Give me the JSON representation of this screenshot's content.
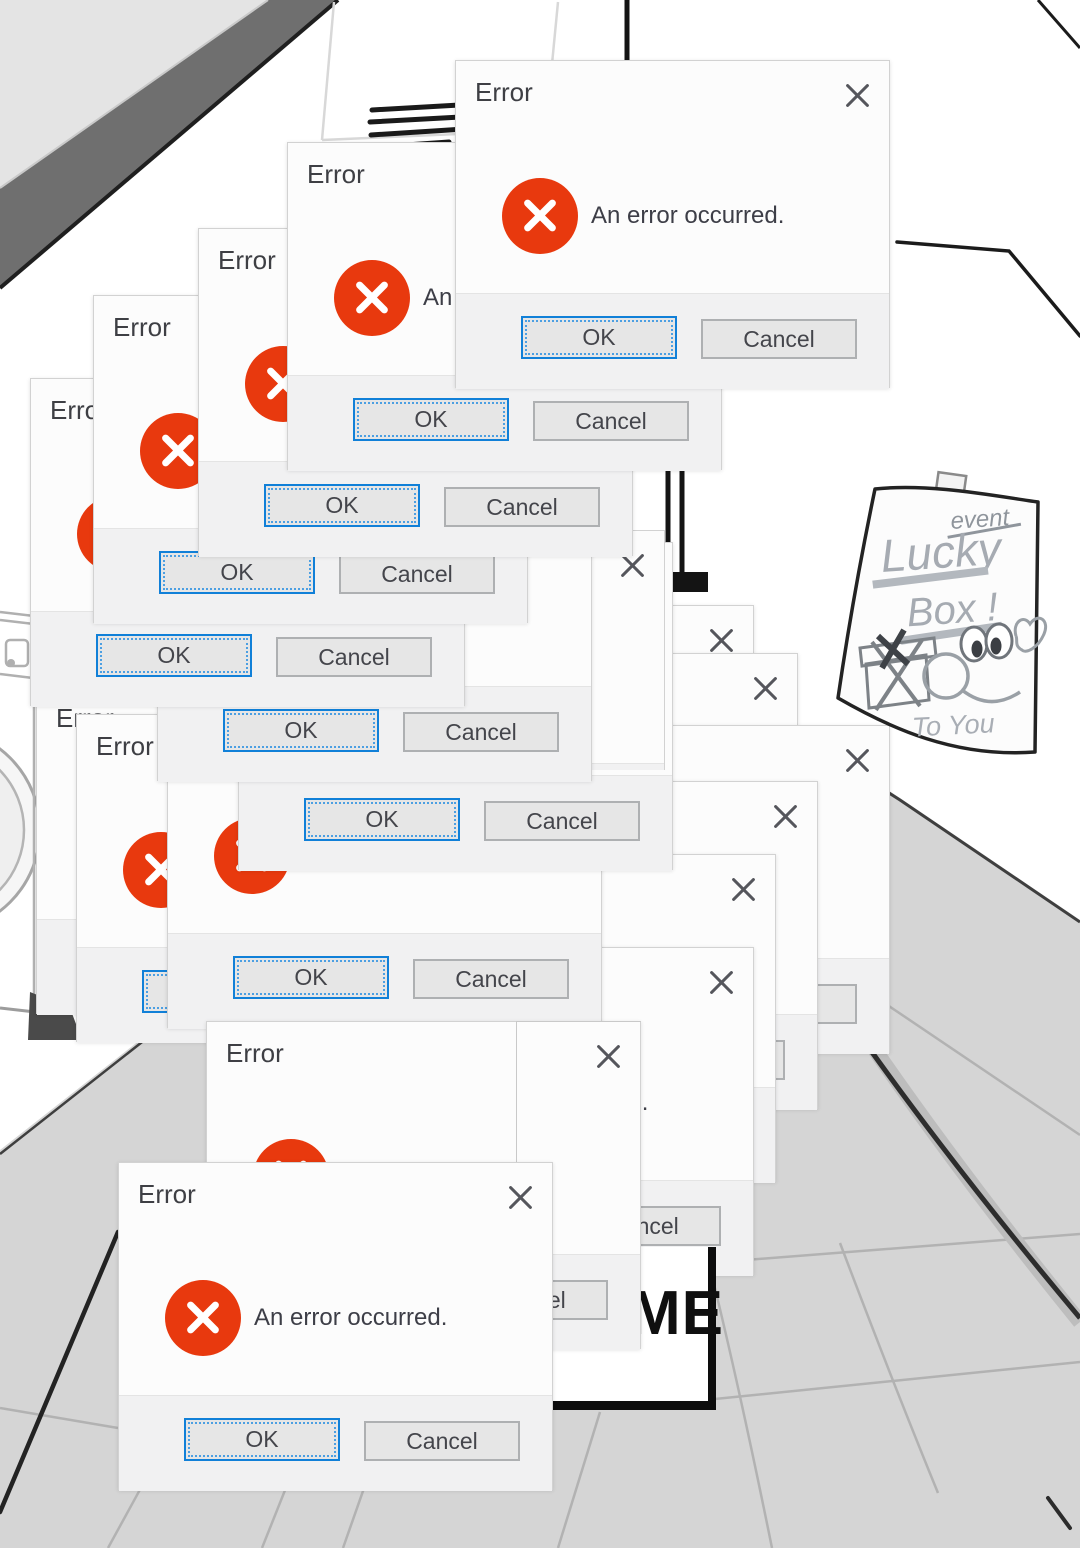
{
  "scene": {
    "width": 1080,
    "height": 1548,
    "description": "hand-drawn laundromat hallway with cascading error popups",
    "floor_color": "#d5d5d5",
    "wall_color": "#ffffff"
  },
  "dialog": {
    "title": "Error",
    "message": "An error occurred.",
    "ok_label": "OK",
    "cancel_label": "Cancel",
    "icon": "error-x-icon",
    "icon_color": "#e8390e",
    "accent_color": "#1180d8"
  },
  "dialogs": [
    {
      "id": "right-1",
      "x": 319,
      "y": 605,
      "layer": "back"
    },
    {
      "id": "right-2",
      "x": 363,
      "y": 653,
      "layer": "back"
    },
    {
      "id": "right-3",
      "x": 455,
      "y": 725,
      "layer": "back"
    },
    {
      "id": "right-4",
      "x": 383,
      "y": 781,
      "layer": "back"
    },
    {
      "id": "right-5",
      "x": 341,
      "y": 854,
      "layer": "back"
    },
    {
      "id": "right-6",
      "x": 319,
      "y": 947,
      "layer": "back"
    },
    {
      "id": "left-back",
      "x": 36,
      "y": 686,
      "layer": "mid"
    },
    {
      "id": "left-front",
      "x": 76,
      "y": 714,
      "layer": "mid"
    },
    {
      "id": "mid-low",
      "x": 167,
      "y": 700,
      "layer": "mid"
    },
    {
      "id": "mid-high",
      "x": 238,
      "y": 542,
      "layer": "mid"
    },
    {
      "id": "strip",
      "x": 230,
      "y": 530,
      "layer": "mid",
      "clip": {
        "left": 357,
        "bottom": 88
      }
    },
    {
      "id": "cascade-6",
      "x": 157,
      "y": 453,
      "layer": "mid"
    },
    {
      "id": "cascade-5",
      "x": 30,
      "y": 378,
      "layer": "mid"
    },
    {
      "id": "cascade-4",
      "x": 93,
      "y": 295,
      "layer": "mid"
    },
    {
      "id": "cascade-3",
      "x": 198,
      "y": 228,
      "layer": "mid"
    },
    {
      "id": "cascade-2",
      "x": 287,
      "y": 142,
      "layer": "mid"
    },
    {
      "id": "bottom-mid",
      "x": 206,
      "y": 1021,
      "layer": "top"
    },
    {
      "id": "bottom-left",
      "x": 118,
      "y": 1162,
      "layer": "top"
    },
    {
      "id": "front",
      "x": 455,
      "y": 60,
      "layer": "top"
    }
  ],
  "poster": {
    "tag": "event",
    "line1": "Lucky",
    "line2": "Box !",
    "signature": "To You"
  },
  "sign": {
    "text": "ME"
  }
}
